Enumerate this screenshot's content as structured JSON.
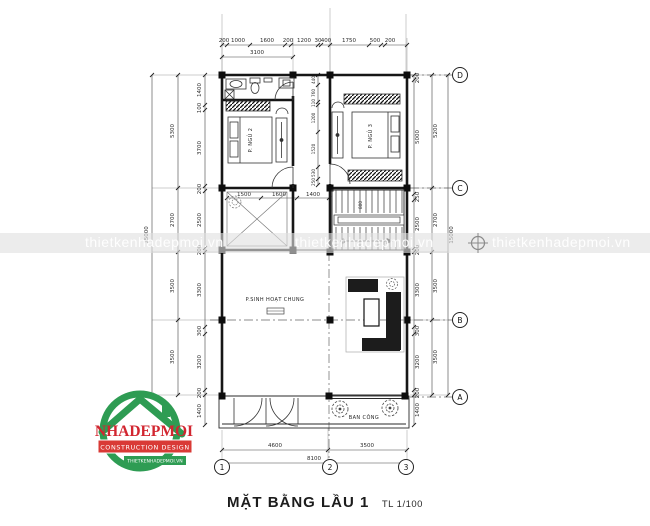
{
  "title": {
    "text": "MẶT BẰNG LẦU 1",
    "scale": "TL 1/100"
  },
  "watermark": {
    "text": "thietkenhadepmoi.vn"
  },
  "logo": {
    "name": "NHADEPMOI",
    "subtitle": "CONSTRUCTION DESIGN",
    "website": "THIETKENHADEPMOI.VN",
    "green": "#2e9c53",
    "red": "#d93a36"
  },
  "rooms": {
    "bedroom2": "P. NGỦ 2",
    "bedroom3": "P. NGỦ 3",
    "living": "P.SINH HOẠT CHUNG",
    "balcony": "BAN CÔNG"
  },
  "axes": {
    "bottom": [
      "1",
      "2",
      "3"
    ],
    "right": [
      "D",
      "C",
      "B",
      "A"
    ]
  },
  "dims": {
    "top1": [
      "200",
      "1000",
      "1600",
      "200",
      "1200",
      "30",
      "400",
      "1750",
      "500",
      "200"
    ],
    "top2": [
      "3100"
    ],
    "bottom1": [
      "4600",
      "3500"
    ],
    "bottom2": [
      "8100"
    ],
    "left_inner": [
      "1400",
      "100",
      "3700",
      "200",
      "2500",
      "200",
      "3300",
      "300",
      "3200",
      "200",
      "1400"
    ],
    "left_mid": [
      "5300",
      "2700",
      "3500",
      "3500"
    ],
    "left_total": "15000",
    "right_inner": [
      "200",
      "5000",
      "250",
      "2500",
      "200",
      "3300",
      "300",
      "3200",
      "200",
      "1400"
    ],
    "right_mid": [
      "5200",
      "2700",
      "3500",
      "3500"
    ],
    "right_total": "15000",
    "corridor": [
      "440",
      "760",
      "110",
      "1200",
      "1520",
      "530",
      "250"
    ],
    "interior": [
      "1500",
      "1600",
      "1400"
    ],
    "stair_width": "800"
  }
}
